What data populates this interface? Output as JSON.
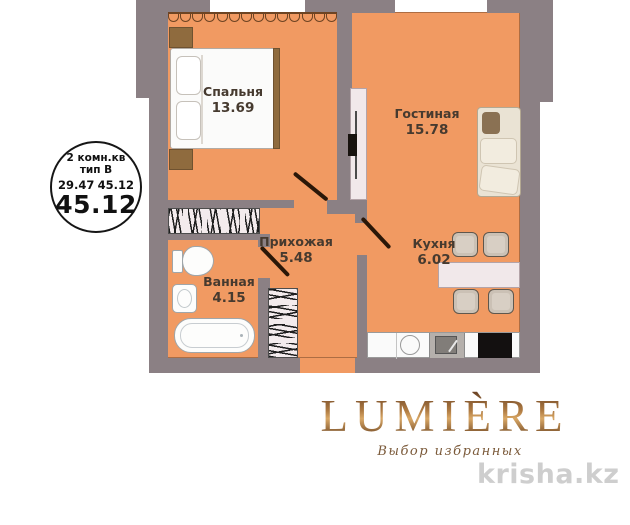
{
  "stamp": {
    "type_line": "2 комн.кв",
    "subtype_line": "тип B",
    "area_left": "29.47",
    "area_right": "45.12",
    "area_total": "45.12"
  },
  "rooms": [
    {
      "key": "bedroom",
      "name": "Спальня",
      "area": "13.69"
    },
    {
      "key": "living_room",
      "name": "Гостиная",
      "area": "15.78"
    },
    {
      "key": "hallway",
      "name": "Прихожая",
      "area": "5.48"
    },
    {
      "key": "kitchen",
      "name": "Кухня",
      "area": "6.02"
    },
    {
      "key": "bathroom",
      "name": "Ванная",
      "area": "4.15"
    }
  ],
  "branding": {
    "logo_text": "LUMIÈRE",
    "tagline": "Выбор избранных",
    "watermark": "krisha.kz"
  },
  "colors": {
    "floor": "#f19a62",
    "wall": "#8b8084",
    "wood": "#8f6b3e",
    "door_line": "#2a1708",
    "label_text": "#463a2f",
    "logo_bronze": "#8a5a2c",
    "watermark_gray": "#c6c6c6"
  }
}
